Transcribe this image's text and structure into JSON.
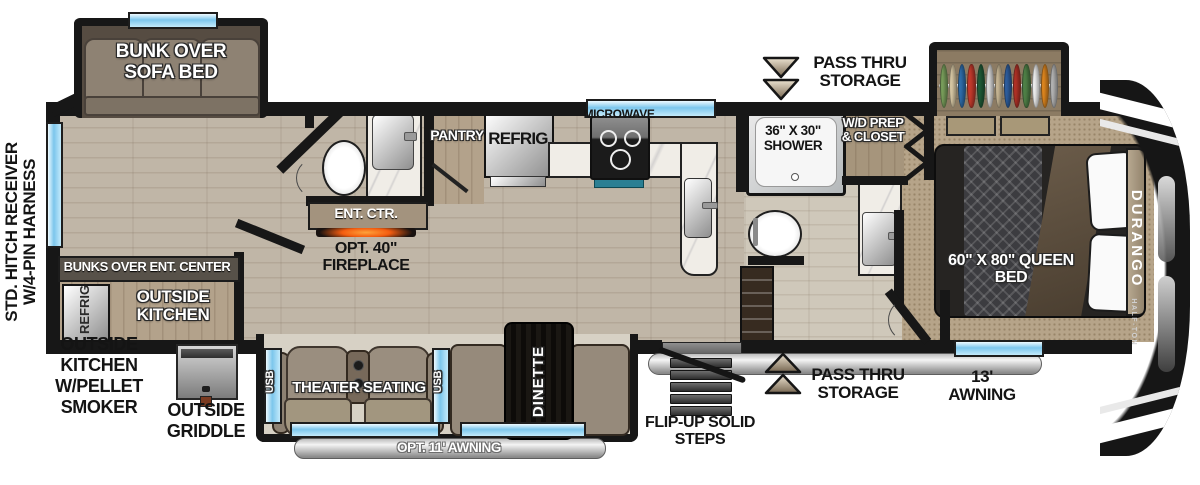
{
  "colors": {
    "window_blue": "#7cc6ec",
    "fireplace_glow": "#ff8c1a",
    "wood_floor": "#c0b6a7",
    "carpet": "#b6a489",
    "cap_black": "#161616",
    "awning_silver": "#d9d9d9",
    "sofa_tan": "#8e8273"
  },
  "exterior": {
    "rear_label_line1": "STD. HITCH RECEIVER",
    "rear_label_line2": "W/4-PIN HARNESS",
    "pass_thru_storage": "PASS THRU STORAGE",
    "awning_13": "13' AWNING",
    "opt_awning_11": "OPT. 11' AWNING",
    "flip_up_steps": "FLIP-UP SOLID STEPS",
    "outside_kitchen_pellet": "OUTSIDE KITCHEN W/PELLET SMOKER",
    "outside_griddle": "OUTSIDE GRIDDLE"
  },
  "rooms": {
    "bunk_slide": "BUNK OVER SOFA BED",
    "bunks_over_ent": "BUNKS OVER ENT. CENTER",
    "outside_kitchen": "OUTSIDE KITCHEN",
    "outside_refrig": "REFRIG",
    "pantry": "PANTRY",
    "refrig": "REFRIG",
    "microwave": "MICROWAVE",
    "ent_ctr": "ENT. CTR.",
    "opt_fireplace": "OPT. 40\" FIREPLACE",
    "shower": "36\" X 30\" SHOWER",
    "wd_closet": "W/D PREP & CLOSET",
    "queen_bed": "60\" X 80\" QUEEN BED",
    "theater_seating": "THEATER SEATING",
    "usb": "USB",
    "dinette": "DINETTE"
  },
  "brand": {
    "name": "DURANGO",
    "sub": "HALF-TON"
  },
  "closet": {
    "clothes_colors": [
      "#7aa05c",
      "#d9c9a5",
      "#2f6fae",
      "#c43a2c",
      "#1f5c38",
      "#dcdcdc",
      "#c9b896",
      "#2f5fa0",
      "#b23227",
      "#4f8047",
      "#f0f0f0",
      "#e0871f",
      "#b5b5b5"
    ]
  }
}
